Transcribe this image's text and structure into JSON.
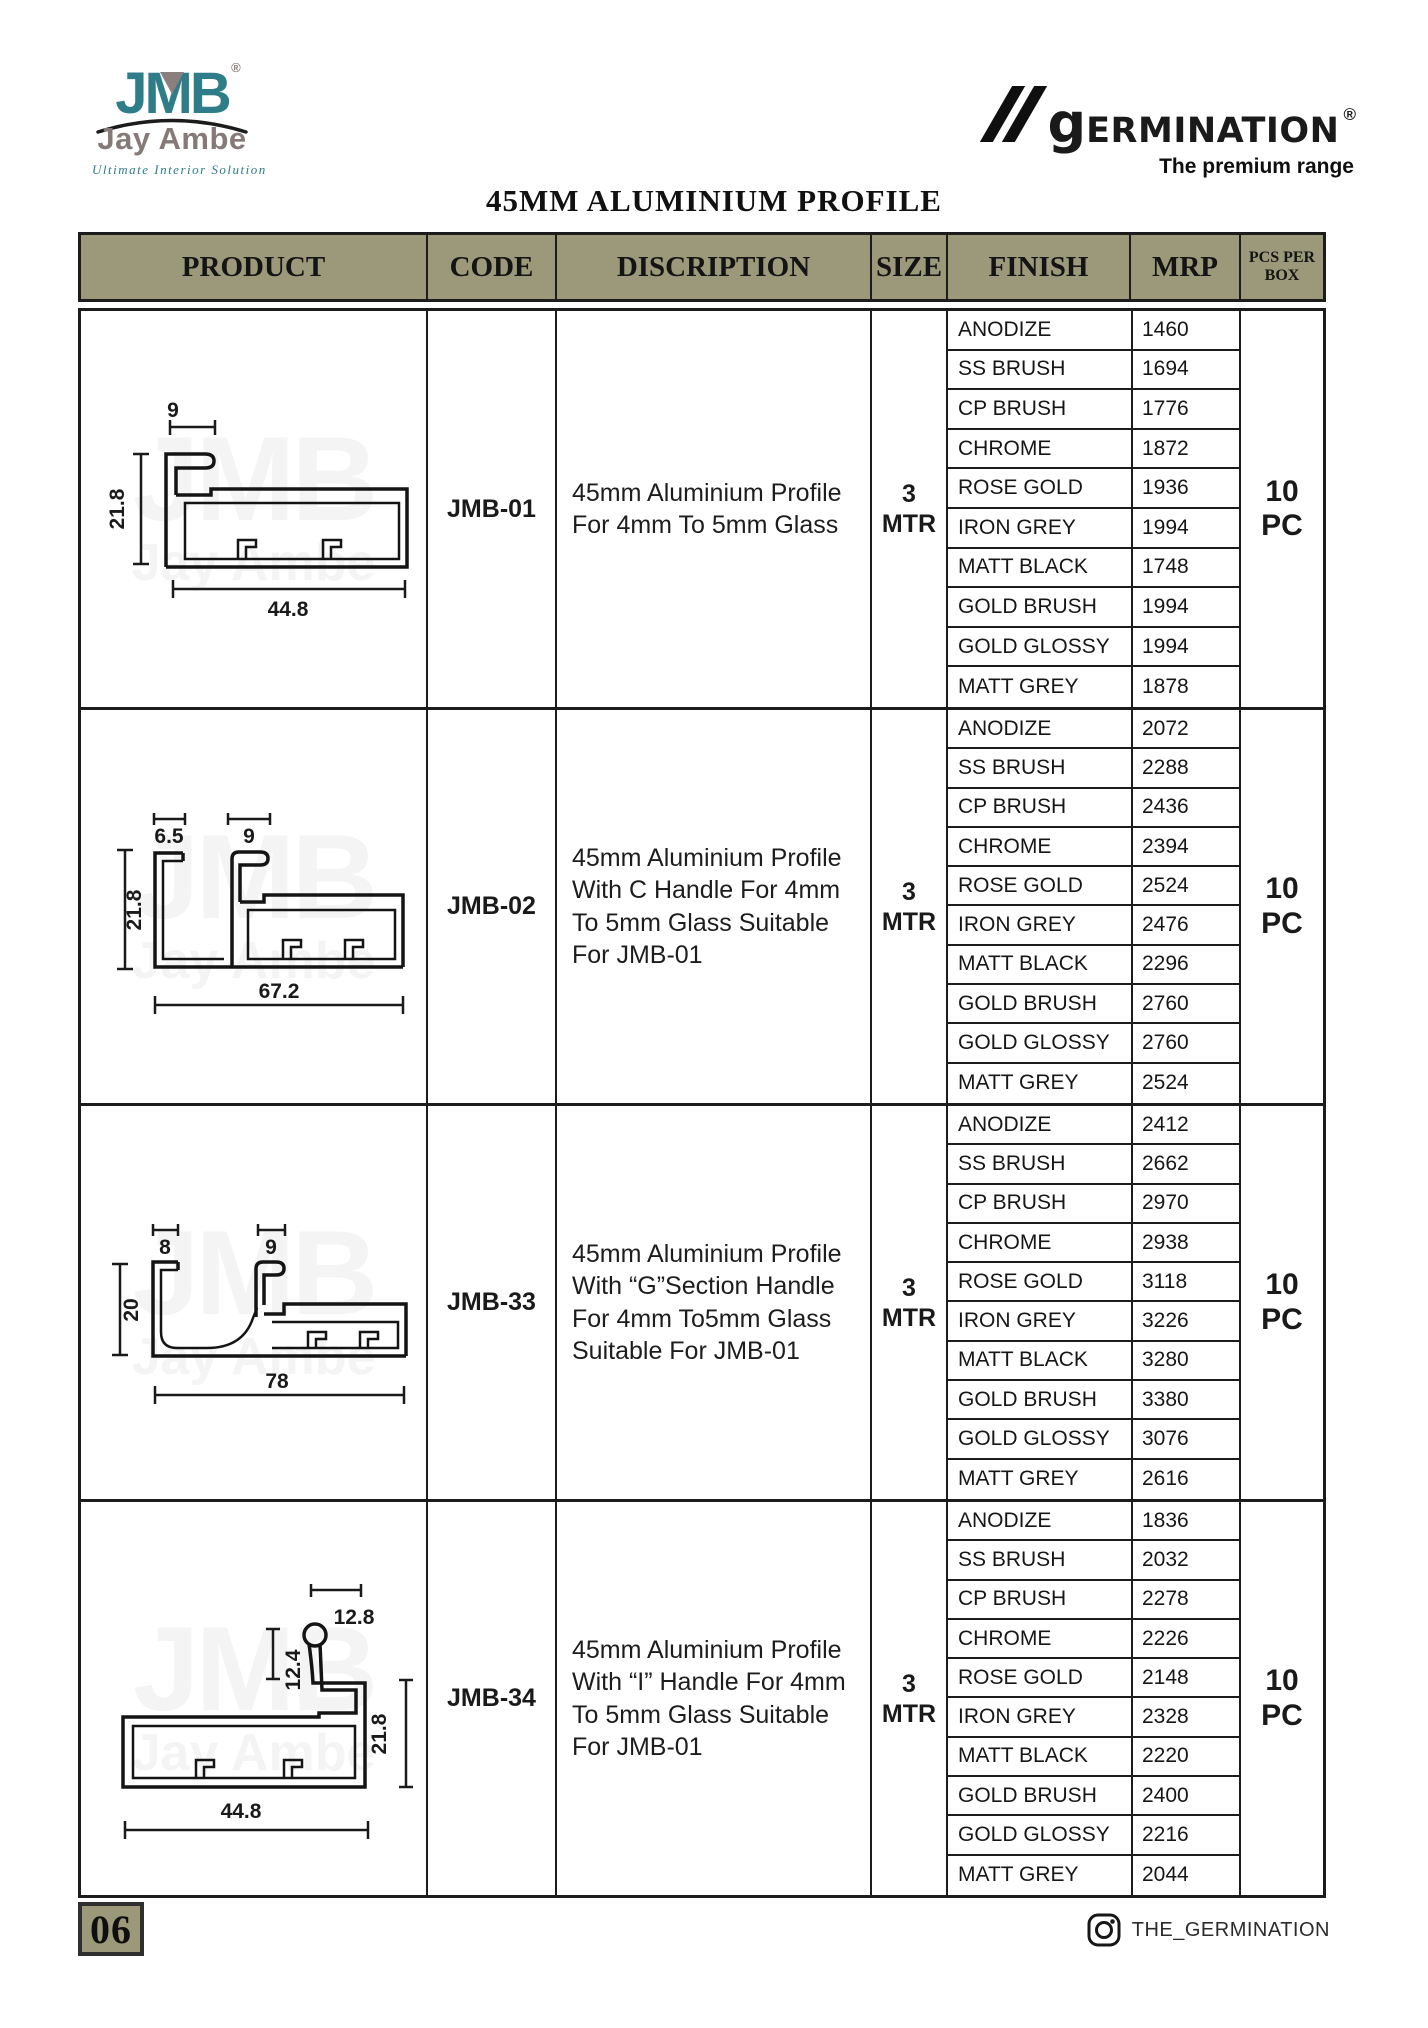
{
  "page": {
    "title": "45MM ALUMINIUM PROFILE",
    "page_number": "06",
    "instagram_handle": "THE_GERMINATION"
  },
  "brand": {
    "jmb_logo_text": "JMB",
    "jmb_registered": "®",
    "jmb_name": "Jay Ambe",
    "jmb_tagline": "Ultimate Interior Solution",
    "germination_g": "g",
    "germination_rest": "ERMINATION",
    "germination_registered": "®",
    "germination_tagline": "The premium range"
  },
  "watermark": {
    "line1": "JMB",
    "line2": "Jay Ambe"
  },
  "colors": {
    "header_olive": "#9b997a",
    "brand_teal": "#2f7d88",
    "brand_grey": "#857a78",
    "ink": "#1a1a1a"
  },
  "table": {
    "headers": [
      "PRODUCT",
      "CODE",
      "DISCRIPTION",
      "SIZE",
      "FINISH",
      "MRP",
      "PCS PER BOX"
    ],
    "rows": [
      {
        "code": "JMB-01",
        "description": "45mm Aluminium Profile For 4mm To 5mm Glass",
        "size_value": "3",
        "size_unit": "MTR",
        "pcs_value": "10",
        "pcs_unit": "PC",
        "drawing": {
          "top": "9",
          "left": "21.8",
          "bottom": "44.8"
        },
        "finishes": [
          {
            "finish": "ANODIZE",
            "mrp": "1460"
          },
          {
            "finish": "SS BRUSH",
            "mrp": "1694"
          },
          {
            "finish": "CP BRUSH",
            "mrp": "1776"
          },
          {
            "finish": "CHROME",
            "mrp": "1872"
          },
          {
            "finish": "ROSE GOLD",
            "mrp": "1936"
          },
          {
            "finish": "IRON GREY",
            "mrp": "1994"
          },
          {
            "finish": "MATT BLACK",
            "mrp": "1748"
          },
          {
            "finish": "GOLD BRUSH",
            "mrp": "1994"
          },
          {
            "finish": "GOLD GLOSSY",
            "mrp": "1994"
          },
          {
            "finish": "MATT GREY",
            "mrp": "1878"
          }
        ]
      },
      {
        "code": "JMB-02",
        "description": "45mm Aluminium Profile With C Handle For 4mm To 5mm Glass Suitable For JMB-01",
        "size_value": "3",
        "size_unit": "MTR",
        "pcs_value": "10",
        "pcs_unit": "PC",
        "drawing": {
          "top_left": "6.5",
          "top": "9",
          "left": "21.8",
          "bottom": "67.2"
        },
        "finishes": [
          {
            "finish": "ANODIZE",
            "mrp": "2072"
          },
          {
            "finish": "SS BRUSH",
            "mrp": "2288"
          },
          {
            "finish": "CP BRUSH",
            "mrp": "2436"
          },
          {
            "finish": "CHROME",
            "mrp": "2394"
          },
          {
            "finish": "ROSE GOLD",
            "mrp": "2524"
          },
          {
            "finish": "IRON GREY",
            "mrp": "2476"
          },
          {
            "finish": "MATT BLACK",
            "mrp": "2296"
          },
          {
            "finish": "GOLD BRUSH",
            "mrp": "2760"
          },
          {
            "finish": "GOLD GLOSSY",
            "mrp": "2760"
          },
          {
            "finish": "MATT GREY",
            "mrp": "2524"
          }
        ]
      },
      {
        "code": "JMB-33",
        "description": "45mm Aluminium Profile With “G”Section Handle For 4mm To5mm Glass Suitable For JMB-01",
        "size_value": "3",
        "size_unit": "MTR",
        "pcs_value": "10",
        "pcs_unit": "PC",
        "drawing": {
          "top_left": "8",
          "top": "9",
          "left": "20",
          "bottom": "78"
        },
        "finishes": [
          {
            "finish": "ANODIZE",
            "mrp": "2412"
          },
          {
            "finish": "SS BRUSH",
            "mrp": "2662"
          },
          {
            "finish": "CP BRUSH",
            "mrp": "2970"
          },
          {
            "finish": "CHROME",
            "mrp": "2938"
          },
          {
            "finish": "ROSE GOLD",
            "mrp": "3118"
          },
          {
            "finish": "IRON GREY",
            "mrp": "3226"
          },
          {
            "finish": "MATT BLACK",
            "mrp": "3280"
          },
          {
            "finish": "GOLD BRUSH",
            "mrp": "3380"
          },
          {
            "finish": "GOLD GLOSSY",
            "mrp": "3076"
          },
          {
            "finish": "MATT GREY",
            "mrp": "2616"
          }
        ]
      },
      {
        "code": "JMB-34",
        "description": "45mm Aluminium Profile With “I” Handle For 4mm To 5mm Glass Suitable For JMB-01",
        "size_value": "3",
        "size_unit": "MTR",
        "pcs_value": "10",
        "pcs_unit": "PC",
        "drawing": {
          "top": "12.8",
          "mid": "12.4",
          "right": "21.8",
          "bottom": "44.8"
        },
        "finishes": [
          {
            "finish": "ANODIZE",
            "mrp": "1836"
          },
          {
            "finish": "SS BRUSH",
            "mrp": "2032"
          },
          {
            "finish": "CP BRUSH",
            "mrp": "2278"
          },
          {
            "finish": "CHROME",
            "mrp": "2226"
          },
          {
            "finish": "ROSE GOLD",
            "mrp": "2148"
          },
          {
            "finish": "IRON GREY",
            "mrp": "2328"
          },
          {
            "finish": "MATT BLACK",
            "mrp": "2220"
          },
          {
            "finish": "GOLD BRUSH",
            "mrp": "2400"
          },
          {
            "finish": "GOLD GLOSSY",
            "mrp": "2216"
          },
          {
            "finish": "MATT GREY",
            "mrp": "2044"
          }
        ]
      }
    ]
  }
}
